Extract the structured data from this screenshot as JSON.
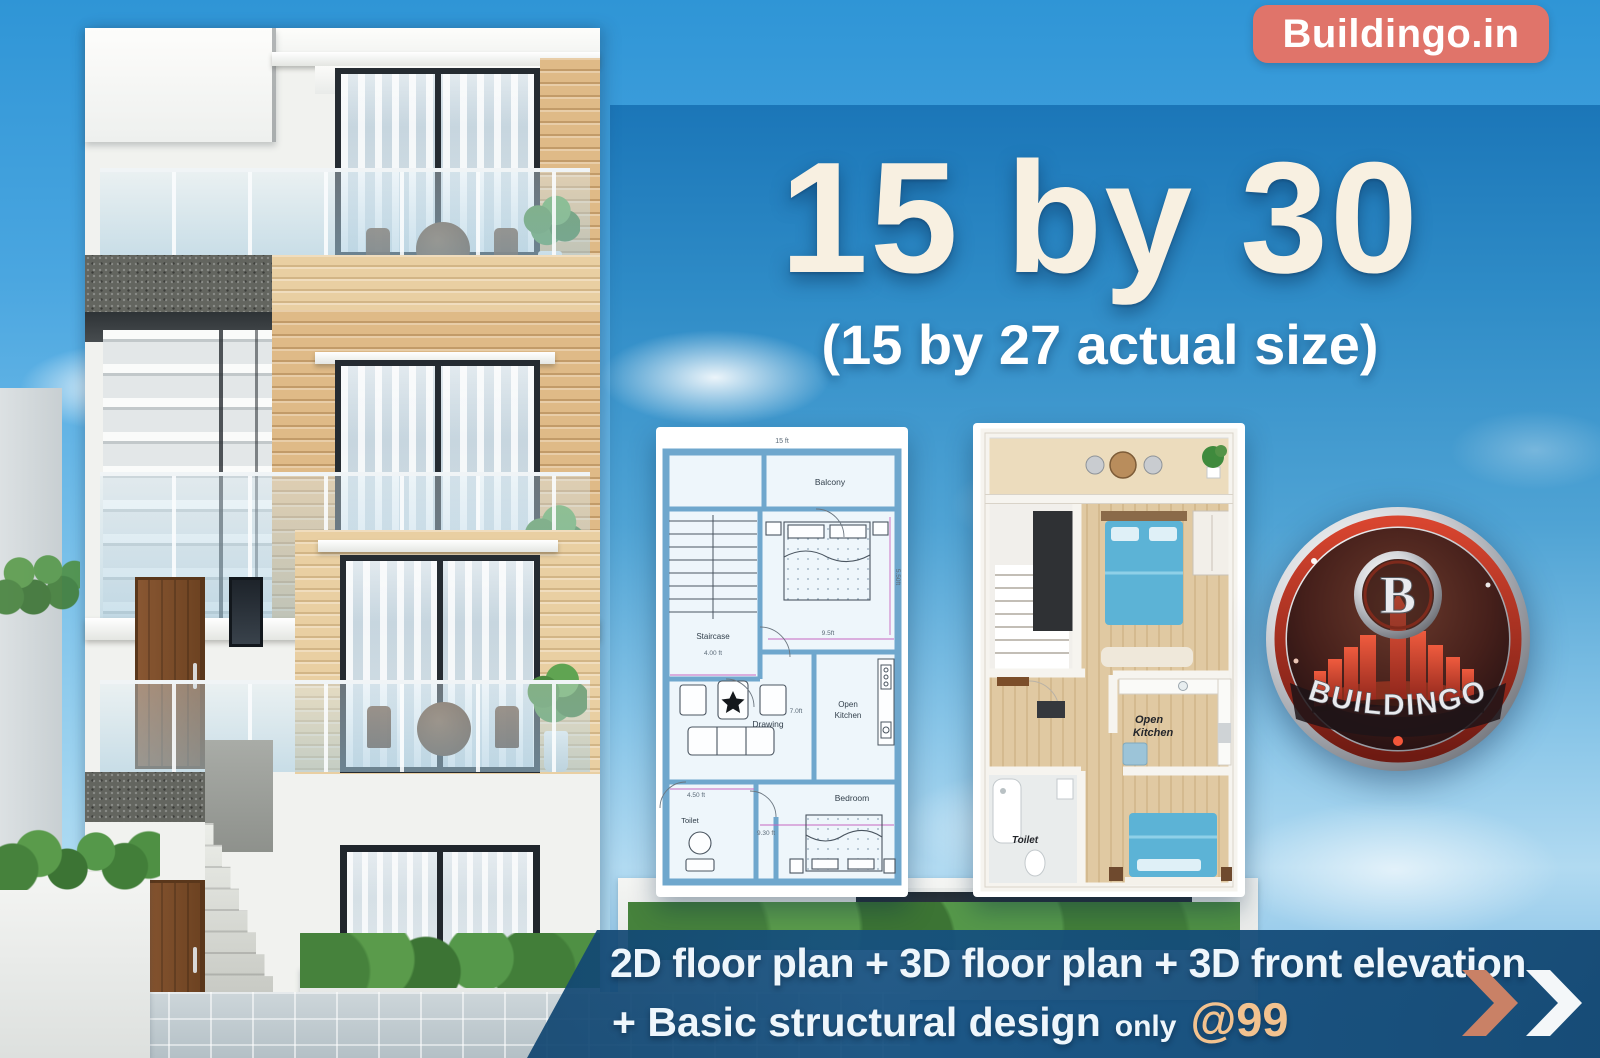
{
  "header": {
    "site_badge": "Buildingo.in"
  },
  "hero": {
    "title": "15 by 30",
    "subtitle": "(15 by 27 actual size)"
  },
  "floor_plan_2d": {
    "dim_top": "15 ft",
    "balcony": "Balcony",
    "staircase": "Staircase",
    "stair_dim": "4.00 ft",
    "bed1_dim_w": "9.5ft",
    "bed1_dim_h": "5.50ft",
    "drawing": "Drawing",
    "drawing_dim": "7.0ft",
    "kitchen_l1": "Open",
    "kitchen_l2": "Kitchen",
    "toilet": "Toilet",
    "toilet_dim": "4.50 ft",
    "bedroom": "Bedroom",
    "bed2_dim": "9.30 ft"
  },
  "floor_plan_3d": {
    "kitchen_l1": "Open",
    "kitchen_l2": "Kitchen",
    "toilet": "Toilet"
  },
  "logo": {
    "letter": "B",
    "brand": "BUILDINGO"
  },
  "footer": {
    "line1": "2D floor plan + 3D floor plan + 3D front elevation",
    "line2": "+ Basic structural design",
    "only": "only",
    "price": "@99"
  },
  "colors": {
    "badge": "#e0746a",
    "band_navy": "#15507f",
    "price_peach": "#f2c28f",
    "arrow_salmon": "#c98166",
    "title_cream": "#f8f0e1",
    "sky_top": "#2f95d6",
    "plan_wall_blue": "#6fa7cd",
    "bed_blue": "#5cb3d6"
  }
}
